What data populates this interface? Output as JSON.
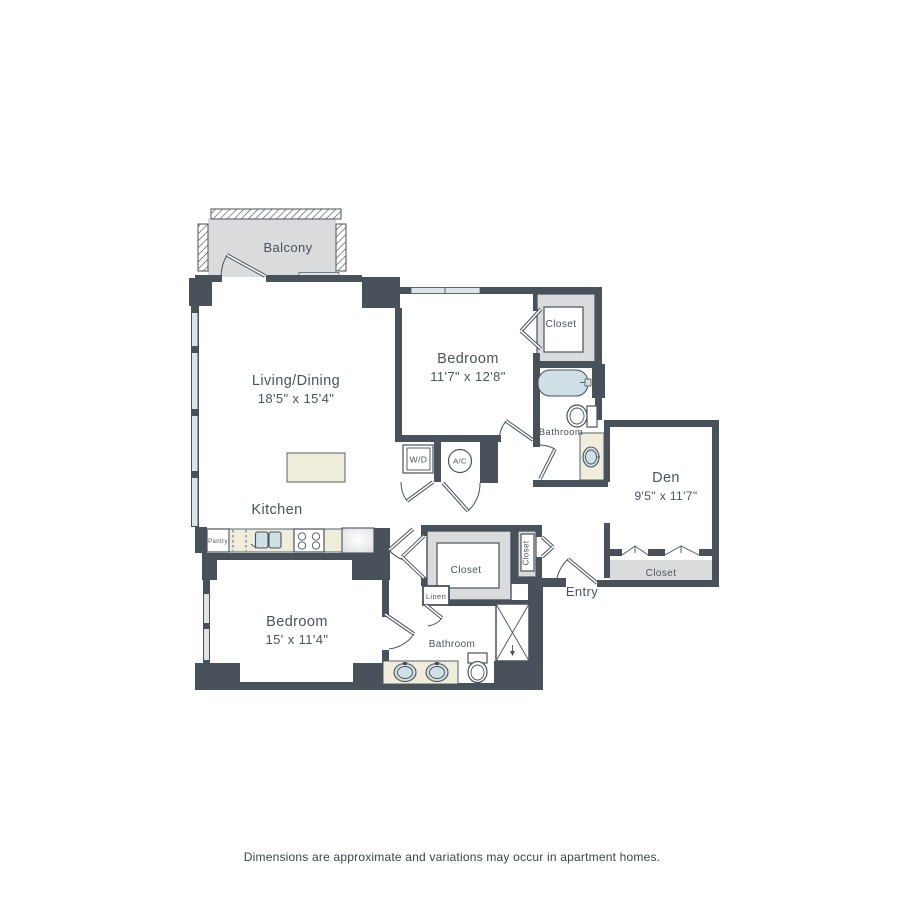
{
  "colors": {
    "wall": "#49525b",
    "gray": "#d9dbdc",
    "cream": "#f0edda",
    "fixture": "#cfdfe5",
    "window": "#dde4e8",
    "label": "#4a535c",
    "disclaimer": "#3d434b"
  },
  "floor_plan": {
    "balcony": {
      "label": "Balcony"
    },
    "living_dining": {
      "label": "Living/Dining",
      "dimensions": "18'5\" x 15'4\""
    },
    "kitchen": {
      "label": "Kitchen"
    },
    "pantry": {
      "label": "Pantry"
    },
    "bedroom_1": {
      "label": "Bedroom",
      "dimensions": "11'7\" x 12'8\""
    },
    "bedroom_1_closet": {
      "label": "Closet"
    },
    "bathroom_1": {
      "label": "Bathroom"
    },
    "washer_dryer": {
      "label": "W/D"
    },
    "ac_unit": {
      "label": "A/C"
    },
    "den": {
      "label": "Den",
      "dimensions": "9'5\" x 11'7\""
    },
    "den_closet": {
      "label": "Closet"
    },
    "entry": {
      "label": "Entry"
    },
    "entry_closet": {
      "label": "Closet"
    },
    "walk_in_closet": {
      "label": "Closet"
    },
    "linen_closet": {
      "label": "Linen"
    },
    "bedroom_2": {
      "label": "Bedroom",
      "dimensions": "15' x 11'4\""
    },
    "bathroom_2": {
      "label": "Bathroom"
    }
  },
  "footer": {
    "disclaimer": "Dimensions are approximate and variations may occur in apartment homes."
  }
}
